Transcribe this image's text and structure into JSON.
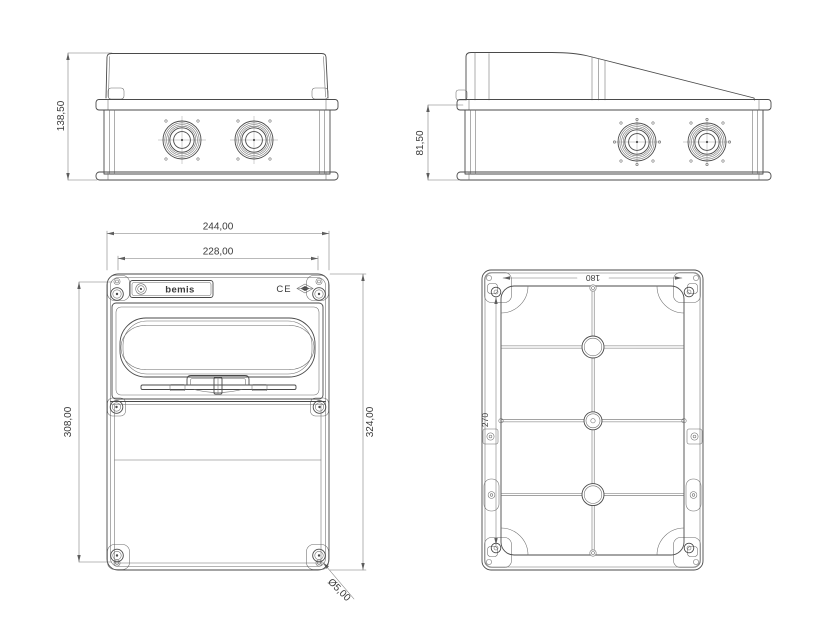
{
  "drawing": {
    "background_color": "#ffffff",
    "line_color": "#4a4a4a",
    "dimension_color": "#757575",
    "text_color": "#3a3a3a",
    "views": {
      "side_long": {
        "height": "138,50"
      },
      "side_short": {
        "height": "81,50"
      },
      "front": {
        "overall_width": "244,00",
        "lid_width": "228,00",
        "mounting_height": "308,00",
        "overall_height": "324,00",
        "hole_diameter": "Ø5,00",
        "brand": "bemis",
        "ce_mark": "CE"
      },
      "back": {
        "mounting_width": "180",
        "mounting_height": "270"
      }
    }
  }
}
